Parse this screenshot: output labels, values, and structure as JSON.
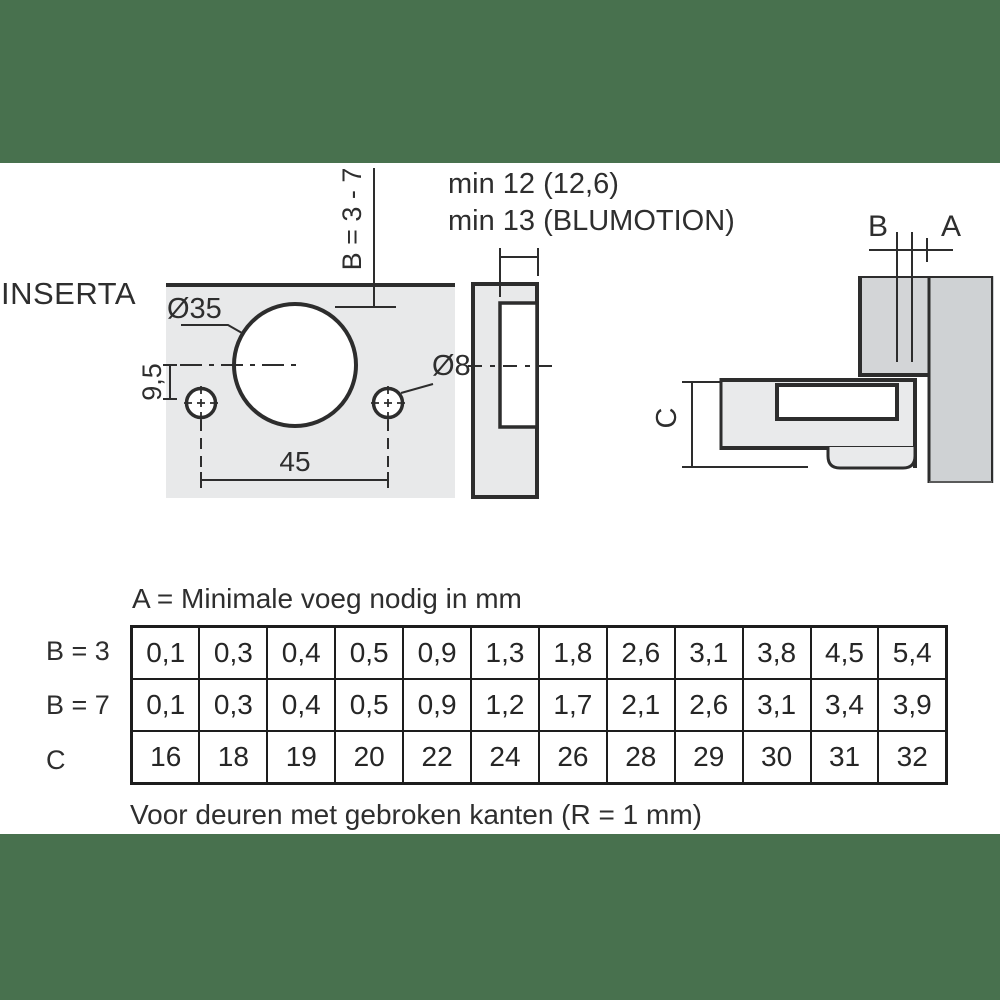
{
  "colors": {
    "band_green": "#48714e",
    "plate_fill": "#e8e9ea",
    "panel_fill": "#d3d5d7",
    "line_dark": "#2d2d2d"
  },
  "product": {
    "name": "INSERTA"
  },
  "diagrams": {
    "front_view": {
      "cup_diameter_label": "Ø35",
      "screw_hole_diameter_label": "Ø8",
      "hole_spacing_label": "45",
      "vertical_offset_label": "9,5",
      "drilling_distance_label": "B = 3 - 7"
    },
    "side_view": {
      "depth_note_line1": "min 12 (12,6)",
      "depth_note_line2": "min 13 (BLUMOTION)"
    },
    "cross_section": {
      "gap_label_b": "B",
      "gap_label_a": "A",
      "height_label_c": "C"
    }
  },
  "table": {
    "caption_top": "A = Minimale voeg nodig in mm",
    "caption_bottom": "Voor deuren met gebroken kanten (R = 1 mm)",
    "rows": [
      {
        "label": "B = 3",
        "values": [
          "0,1",
          "0,3",
          "0,4",
          "0,5",
          "0,9",
          "1,3",
          "1,8",
          "2,6",
          "3,1",
          "3,8",
          "4,5",
          "5,4"
        ]
      },
      {
        "label": "B = 7",
        "values": [
          "0,1",
          "0,3",
          "0,4",
          "0,5",
          "0,9",
          "1,2",
          "1,7",
          "2,1",
          "2,6",
          "3,1",
          "3,4",
          "3,9"
        ]
      },
      {
        "label": "C",
        "values": [
          "16",
          "18",
          "19",
          "20",
          "22",
          "24",
          "26",
          "28",
          "29",
          "30",
          "31",
          "32"
        ]
      }
    ]
  }
}
